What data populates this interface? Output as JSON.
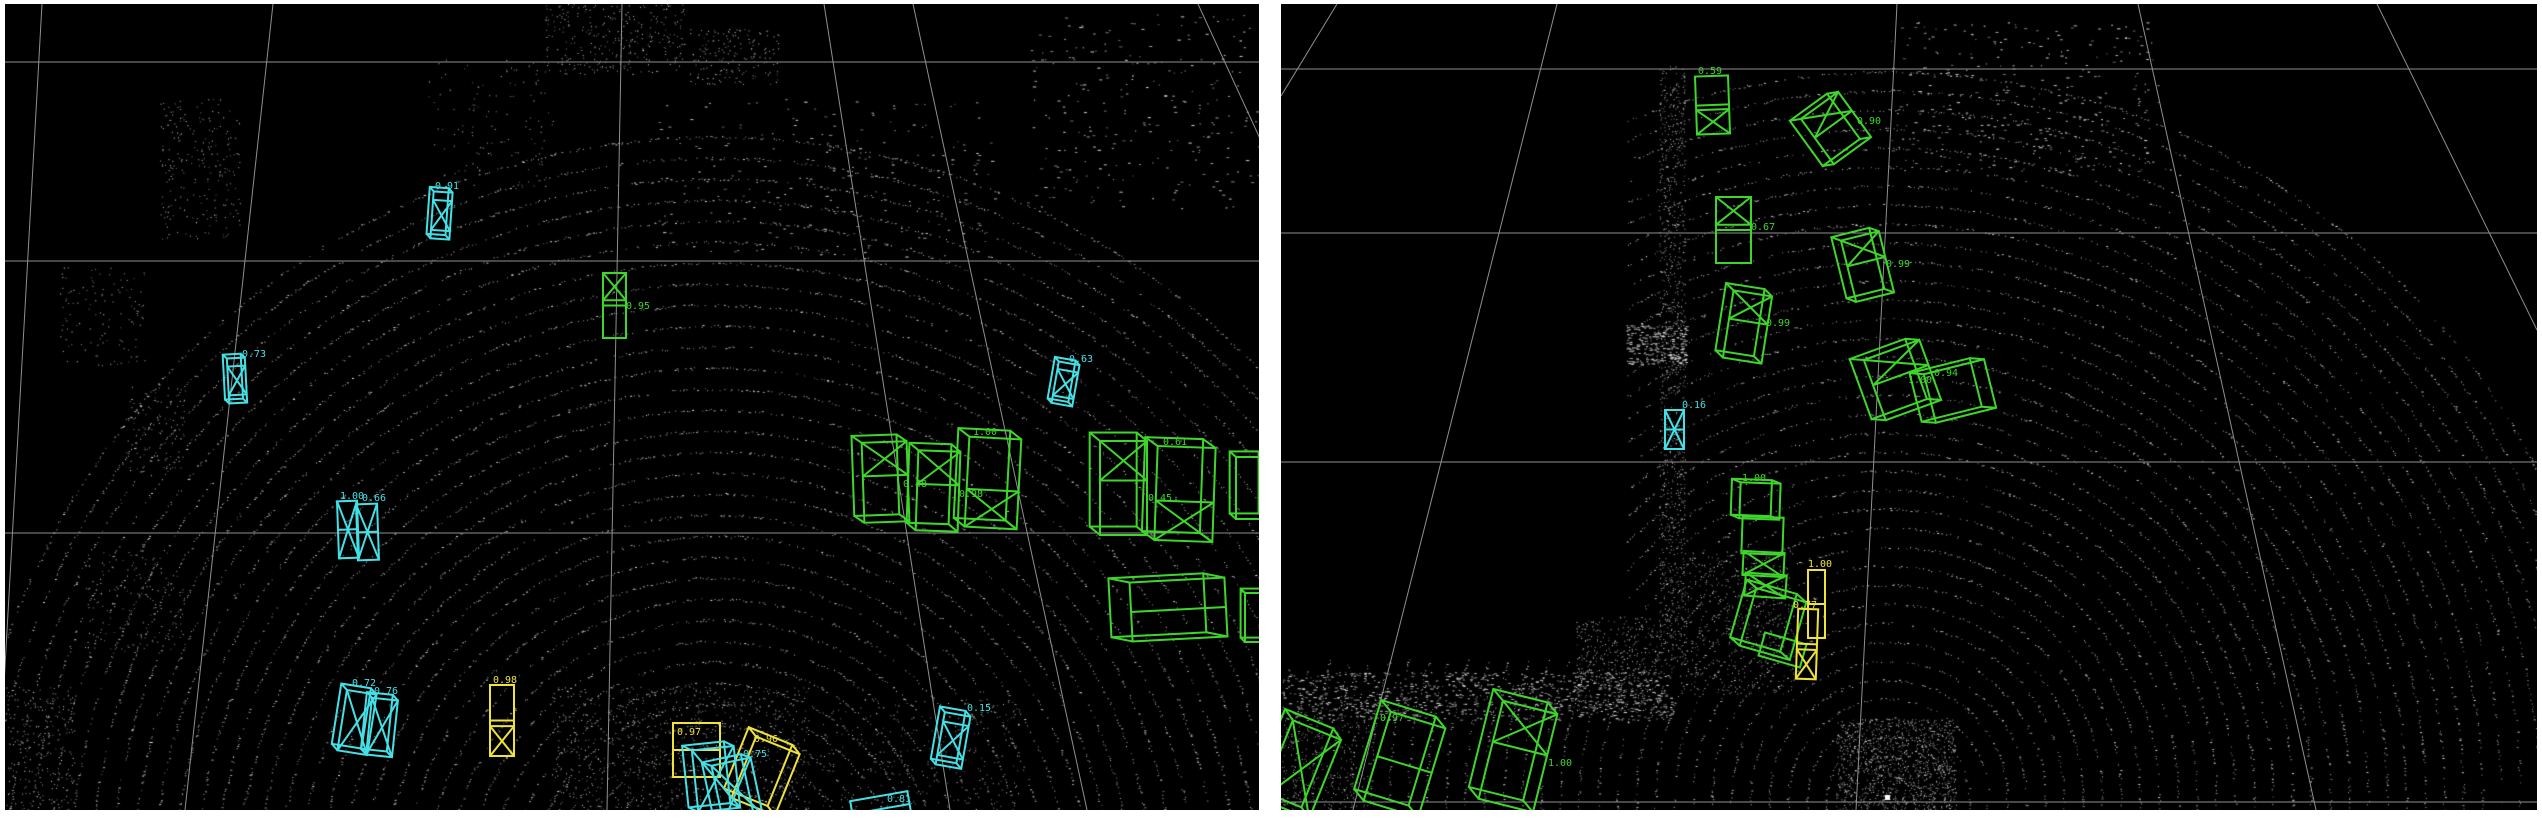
{
  "app": {
    "description": "LiDAR point-cloud 3D detection viewer, two side-by-side viewports with confidence-labeled bounding boxes",
    "background": "#ffffff",
    "panel_background": "#000000",
    "grid_color": "#8f8f8f",
    "point_color": "#e6e6e6",
    "class_colors": {
      "vehicle": "#3fd62b",
      "pedestrian": "#45e0e6",
      "cyclist": "#efe23a"
    }
  },
  "panels": [
    {
      "name": "left-viewport",
      "x": 5,
      "y": 4,
      "w": 1254,
      "h": 806,
      "grid": {
        "h_lines": [
          58,
          257,
          529
        ],
        "fan_lines": [
          [
            37,
            0,
            -8,
            806
          ],
          [
            268,
            0,
            180,
            806
          ],
          [
            617,
            0,
            602,
            806
          ],
          [
            819,
            0,
            945,
            806
          ],
          [
            908,
            0,
            1082,
            806
          ],
          [
            1193,
            0,
            1275,
            178
          ]
        ]
      },
      "rings": {
        "cx": 710,
        "cy": 884,
        "r0": 100,
        "r1": 770,
        "step": 21,
        "astart": 180,
        "aend": 360,
        "skip": 0.45
      },
      "clusters": [
        {
          "x": 155,
          "y": 95,
          "w": 80,
          "h": 140,
          "n": 240
        },
        {
          "x": 540,
          "y": 0,
          "w": 140,
          "h": 70,
          "n": 320
        },
        {
          "x": 685,
          "y": 25,
          "w": 90,
          "h": 55,
          "n": 180
        },
        {
          "x": 1020,
          "y": 10,
          "w": 240,
          "h": 195,
          "n": 260,
          "dash": true
        },
        {
          "x": 420,
          "y": 55,
          "w": 130,
          "h": 130,
          "n": 130
        },
        {
          "x": 55,
          "y": 262,
          "w": 85,
          "h": 100,
          "n": 130
        },
        {
          "x": 120,
          "y": 382,
          "w": 60,
          "h": 90,
          "n": 110
        },
        {
          "x": 80,
          "y": 548,
          "w": 100,
          "h": 100,
          "n": 150
        },
        {
          "x": 0,
          "y": 682,
          "w": 70,
          "h": 125,
          "n": 260
        },
        {
          "x": 545,
          "y": 682,
          "w": 260,
          "h": 125,
          "n": 900
        },
        {
          "x": 815,
          "y": 695,
          "w": 200,
          "h": 112,
          "n": 300
        },
        {
          "x": 650,
          "y": 95,
          "w": 340,
          "h": 160,
          "n": 220,
          "dash": true
        }
      ],
      "boxes": [
        {
          "x": 427,
          "y": 188,
          "w": 19,
          "h": 47,
          "r": 4,
          "c": "pedestrian",
          "s": [
            "persp",
            "caps"
          ],
          "label": "0.91",
          "lx": 430,
          "ly": 185
        },
        {
          "x": 223,
          "y": 354,
          "w": 18,
          "h": 45,
          "r": -3,
          "c": "pedestrian",
          "s": [
            "persp",
            "caps"
          ],
          "label": "0.73",
          "lx": 237,
          "ly": 353
        },
        {
          "x": 598,
          "y": 269,
          "w": 23,
          "h": 65,
          "r": 0,
          "c": "vehicle",
          "s": [
            "xtop",
            "mid"
          ],
          "label": "0.95",
          "lx": 621,
          "ly": 305
        },
        {
          "x": 333,
          "y": 497,
          "w": 20,
          "h": 57,
          "r": -2,
          "c": "pedestrian",
          "s": [
            "xfull",
            "mid"
          ],
          "label": "1.00",
          "lx": 335,
          "ly": 495
        },
        {
          "x": 352,
          "y": 500,
          "w": 21,
          "h": 56,
          "r": -2,
          "c": "pedestrian",
          "s": [
            "xfull",
            "mid"
          ],
          "label": "0.66",
          "lx": 357,
          "ly": 497
        },
        {
          "x": 337,
          "y": 688,
          "w": 30,
          "h": 61,
          "r": 9,
          "c": "pedestrian",
          "s": [
            "persp",
            "xfull"
          ],
          "label": "0.72",
          "lx": 347,
          "ly": 682
        },
        {
          "x": 364,
          "y": 695,
          "w": 26,
          "h": 57,
          "r": 6,
          "c": "pedestrian",
          "s": [
            "persp",
            "xfull"
          ],
          "label": "0.76",
          "lx": 369,
          "ly": 690
        },
        {
          "x": 485,
          "y": 681,
          "w": 24,
          "h": 71,
          "r": 0,
          "c": "cyclist",
          "s": [
            "xbottom",
            "mid"
          ],
          "label": "0.98",
          "lx": 488,
          "ly": 679
        },
        {
          "x": 668,
          "y": 719,
          "w": 47,
          "h": 54,
          "r": 0,
          "c": "cyclist",
          "s": [
            "mid"
          ],
          "label": "0.97",
          "lx": 672,
          "ly": 731
        },
        {
          "x": 737,
          "y": 739,
          "w": 47,
          "h": 66,
          "r": 22,
          "c": "cyclist",
          "s": [
            "persp"
          ],
          "label": "0.96",
          "lx": 749,
          "ly": 738
        },
        {
          "x": 690,
          "y": 744,
          "w": 42,
          "h": 62,
          "r": -6,
          "c": "pedestrian",
          "s": [
            "persp",
            "xfull"
          ],
          "label": ""
        },
        {
          "x": 712,
          "y": 757,
          "w": 40,
          "h": 58,
          "r": -12,
          "c": "pedestrian",
          "s": [
            "persp",
            "xfull"
          ],
          "label": "0.75",
          "lx": 738,
          "ly": 753
        },
        {
          "x": 935,
          "y": 710,
          "w": 26,
          "h": 53,
          "r": 10,
          "c": "pedestrian",
          "s": [
            "persp",
            "caps"
          ],
          "label": "0.15",
          "lx": 962,
          "ly": 707
        },
        {
          "x": 847,
          "y": 792,
          "w": 58,
          "h": 26,
          "r": -10,
          "c": "pedestrian",
          "s": [
            "mid"
          ],
          "label": "0.81",
          "lx": 882,
          "ly": 798
        },
        {
          "x": 858,
          "y": 438,
          "w": 45,
          "h": 80,
          "r": -2,
          "c": "vehicle",
          "s": [
            "persp",
            "xtop"
          ],
          "label": "0.48",
          "lx": 898,
          "ly": 483
        },
        {
          "x": 912,
          "y": 447,
          "w": 42,
          "h": 80,
          "r": 2,
          "c": "vehicle",
          "s": [
            "persp",
            "xtop"
          ],
          "label": "0.98",
          "lx": 954,
          "ly": 493
        },
        {
          "x": 962,
          "y": 434,
          "w": 52,
          "h": 90,
          "r": 3,
          "c": "vehicle",
          "s": [
            "persp",
            "xbottom"
          ],
          "label": "1.00",
          "lx": 968,
          "ly": 431
        },
        {
          "x": 1095,
          "y": 437,
          "w": 47,
          "h": 94,
          "r": 0,
          "c": "vehicle",
          "s": [
            "persp",
            "xtop"
          ],
          "label": "0.45",
          "lx": 1143,
          "ly": 497
        },
        {
          "x": 1151,
          "y": 443,
          "w": 58,
          "h": 94,
          "r": 2,
          "c": "vehicle",
          "s": [
            "persp",
            "xbottom"
          ],
          "label": "0.61",
          "lx": 1158,
          "ly": 441
        },
        {
          "x": 1231,
          "y": 453,
          "w": 29,
          "h": 62,
          "r": 0,
          "c": "vehicle",
          "s": [
            "persp"
          ],
          "label": ""
        },
        {
          "x": 1126,
          "y": 576,
          "w": 95,
          "h": 59,
          "r": -3,
          "c": "vehicle",
          "s": [
            "persp",
            "mid"
          ],
          "label": ""
        },
        {
          "x": 1240,
          "y": 589,
          "w": 20,
          "h": 49,
          "r": 0,
          "c": "vehicle",
          "s": [
            "persp"
          ],
          "label": ""
        },
        {
          "x": 1050,
          "y": 359,
          "w": 21,
          "h": 42,
          "r": 10,
          "c": "pedestrian",
          "s": [
            "persp",
            "caps"
          ],
          "label": "0.63",
          "lx": 1064,
          "ly": 358
        }
      ]
    },
    {
      "name": "right-viewport",
      "x": 1281,
      "y": 4,
      "w": 1256,
      "h": 806,
      "grid": {
        "h_lines": [
          65,
          229,
          458,
          798
        ],
        "fan_lines": [
          [
            56,
            0,
            0,
            92
          ],
          [
            276,
            0,
            72,
            806
          ],
          [
            616,
            0,
            575,
            806
          ],
          [
            857,
            0,
            1035,
            806
          ],
          [
            1096,
            0,
            1256,
            326
          ]
        ]
      },
      "rings": {
        "cx": 607,
        "cy": 795,
        "r0": 24,
        "r1": 740,
        "step": 19,
        "astart": 0,
        "aend": 360,
        "skip": 0.5,
        "mask": {
          "x": 0,
          "y": 0,
          "w": 345,
          "h": 655
        }
      },
      "ego_marker": {
        "x": 604,
        "y": 791,
        "size": 5
      },
      "clusters": [
        {
          "x": 378,
          "y": 62,
          "w": 26,
          "h": 600,
          "n": 1000
        },
        {
          "x": 345,
          "y": 320,
          "w": 60,
          "h": 40,
          "n": 260,
          "dash": true
        },
        {
          "x": 295,
          "y": 612,
          "w": 85,
          "h": 95,
          "n": 450
        },
        {
          "x": 0,
          "y": 668,
          "w": 390,
          "h": 48,
          "n": 900,
          "dash": true
        },
        {
          "x": 0,
          "y": 700,
          "w": 90,
          "h": 108,
          "n": 350
        },
        {
          "x": 398,
          "y": 545,
          "w": 115,
          "h": 145,
          "n": 600
        },
        {
          "x": 610,
          "y": 18,
          "w": 270,
          "h": 150,
          "n": 330,
          "dash": true
        },
        {
          "x": 555,
          "y": 715,
          "w": 120,
          "h": 92,
          "n": 1200
        }
      ],
      "boxes": [
        {
          "x": 415,
          "y": 72,
          "w": 33,
          "h": 58,
          "r": -2,
          "c": "vehicle",
          "s": [
            "xbottom",
            "mid"
          ],
          "label": "0.59",
          "lx": 417,
          "ly": 70
        },
        {
          "x": 532,
          "y": 96,
          "w": 46,
          "h": 56,
          "r": -36,
          "c": "vehicle",
          "s": [
            "persp",
            "xtop"
          ],
          "label": "0.90",
          "lx": 576,
          "ly": 120
        },
        {
          "x": 435,
          "y": 193,
          "w": 35,
          "h": 66,
          "r": 0,
          "c": "vehicle",
          "s": [
            "xtop",
            "mid"
          ],
          "label": "0.67",
          "lx": 470,
          "ly": 226
        },
        {
          "x": 567,
          "y": 231,
          "w": 39,
          "h": 63,
          "r": -14,
          "c": "vehicle",
          "s": [
            "persp",
            "xtop"
          ],
          "label": "0.99",
          "lx": 605,
          "ly": 263
        },
        {
          "x": 447,
          "y": 289,
          "w": 39,
          "h": 68,
          "r": 9,
          "c": "vehicle",
          "s": [
            "persp",
            "xtop"
          ],
          "label": "0.99",
          "lx": 485,
          "ly": 322
        },
        {
          "x": 592,
          "y": 344,
          "w": 59,
          "h": 64,
          "r": -20,
          "c": "vehicle",
          "s": [
            "persp",
            "xtop"
          ],
          "label": "1.00",
          "lx": 627,
          "ly": 379
        },
        {
          "x": 648,
          "y": 362,
          "w": 62,
          "h": 50,
          "r": -14,
          "c": "vehicle",
          "s": [
            "persp"
          ],
          "label": "0.94",
          "lx": 653,
          "ly": 372
        },
        {
          "x": 384,
          "y": 406,
          "w": 19,
          "h": 39,
          "r": 0,
          "c": "pedestrian",
          "s": [
            "xfull",
            "mid"
          ],
          "label": "0.16",
          "lx": 401,
          "ly": 404
        },
        {
          "x": 459,
          "y": 479,
          "w": 40,
          "h": 36,
          "r": 2,
          "c": "vehicle",
          "s": [
            "persp"
          ],
          "label": "1.00",
          "lx": 461,
          "ly": 477
        },
        {
          "x": 461,
          "y": 513,
          "w": 41,
          "h": 37,
          "r": 2,
          "c": "vehicle",
          "s": [],
          "label": ""
        },
        {
          "x": 462,
          "y": 548,
          "w": 41,
          "h": 24,
          "r": 3,
          "c": "vehicle",
          "s": [
            "xfull"
          ],
          "label": ""
        },
        {
          "x": 464,
          "y": 570,
          "w": 41,
          "h": 23,
          "r": 4,
          "c": "vehicle",
          "s": [
            "xfull"
          ],
          "label": ""
        },
        {
          "x": 466,
          "y": 590,
          "w": 52,
          "h": 60,
          "r": 16,
          "c": "vehicle",
          "s": [
            "persp"
          ],
          "label": ""
        },
        {
          "x": 480,
          "y": 634,
          "w": 43,
          "h": 24,
          "r": 16,
          "c": "vehicle",
          "s": [],
          "label": ""
        },
        {
          "x": 527,
          "y": 566,
          "w": 17,
          "h": 68,
          "r": 0,
          "c": "cyclist",
          "s": [
            "mid"
          ],
          "label": "1.00",
          "lx": 527,
          "ly": 563
        },
        {
          "x": 516,
          "y": 605,
          "w": 20,
          "h": 70,
          "r": 2,
          "c": "cyclist",
          "s": [
            "xbottom",
            "mid"
          ],
          "label": "0.77",
          "lx": 512,
          "ly": 604
        },
        {
          "x": 95,
          "y": 714,
          "w": 57,
          "h": 93,
          "r": 17,
          "c": "vehicle",
          "s": [
            "persp",
            "mid"
          ],
          "label": "0.97",
          "lx": 99,
          "ly": 717
        },
        {
          "x": 209,
          "y": 702,
          "w": 56,
          "h": 101,
          "r": 14,
          "c": "vehicle",
          "s": [
            "persp",
            "xtop"
          ],
          "label": "1.00",
          "lx": 267,
          "ly": 762
        },
        {
          "x": -6,
          "y": 723,
          "w": 52,
          "h": 85,
          "r": 22,
          "c": "vehicle",
          "s": [
            "persp",
            "xfull"
          ],
          "label": ""
        }
      ]
    }
  ]
}
